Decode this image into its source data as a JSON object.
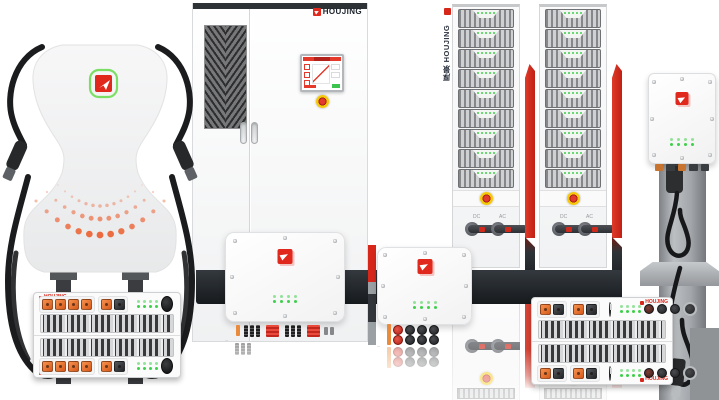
{
  "brand": {
    "name": "HOUJING",
    "name_vertical": "厚景 HOUJING",
    "logo_red": "#e0281c",
    "logo_green_ring": "#7bdf63"
  },
  "colors": {
    "stripe_red": "#d7271b",
    "accent_orange": "#ec6a3e",
    "led_green": "#3fd04b",
    "estop_yellow": "#f5c80a",
    "estop_red": "#e23b2e",
    "dark_base": "#24282c",
    "cable_black": "#1b1c1e",
    "metal_gray": "#9a9da1"
  },
  "products": {
    "charging_pile": {
      "guns": 2,
      "led_arcs": 3,
      "dots_per_arc": 13
    },
    "power_cabinet": {
      "logo_text": "HOUJING",
      "doors": 2,
      "has_screen": true,
      "has_estop": true
    },
    "module_towers": {
      "count": 2,
      "modules_per_tower": 9,
      "leds_per_module": 5,
      "switch_labels": [
        "DC",
        "AC"
      ],
      "estops_per_tower": 1
    },
    "wallbox_center": {
      "led_cols": 4,
      "terminal_bars_per_group": 3
    },
    "wallbox_small": {
      "led_cols": 4,
      "round_connectors": [
        "red",
        "dark",
        "dark",
        "dark"
      ]
    },
    "rack_modules_left": {
      "units": 2,
      "led_cols": 4,
      "group1": [
        "orange",
        "orange",
        "orange",
        "orange"
      ],
      "group2": [
        "orange",
        "black"
      ]
    },
    "rack_modules_right": {
      "units": 2,
      "led_cols": 4,
      "square_group": [
        "orange",
        "black"
      ],
      "round_connectors": [
        "maroon",
        "dark",
        "dark",
        "ringed"
      ],
      "has_knob": true
    },
    "wall_charger": {
      "led_cols": 4,
      "guns": 1
    }
  }
}
